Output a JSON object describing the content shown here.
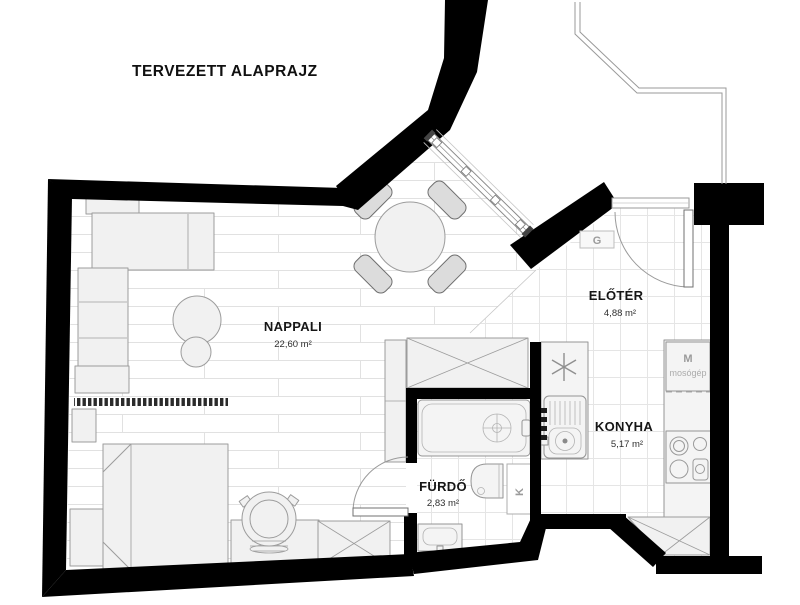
{
  "title": "TERVEZETT ALAPRAJZ",
  "rooms": [
    {
      "id": "nappali",
      "name": "NAPPALI",
      "area": "22,60 m²"
    },
    {
      "id": "eloter",
      "name": "ELŐTÉR",
      "area": "4,88 m²"
    },
    {
      "id": "konyha",
      "name": "KONYHA",
      "area": "5,17 m²"
    },
    {
      "id": "furdo",
      "name": "FÜRDŐ",
      "area": "2,83 m²"
    }
  ],
  "annotations": {
    "gas_meter": "G",
    "flue": "K",
    "washing_machine_letter": "M",
    "washing_machine_label": "mosógép"
  },
  "colors": {
    "wall_color": "#000000",
    "furniture_fill": "#f1f1f1",
    "furniture_stroke": "#9c9c9c",
    "wood_line": "#e1e1e1",
    "tile_line": "#e5e5e5",
    "label_muted": "#9b9b9b"
  }
}
